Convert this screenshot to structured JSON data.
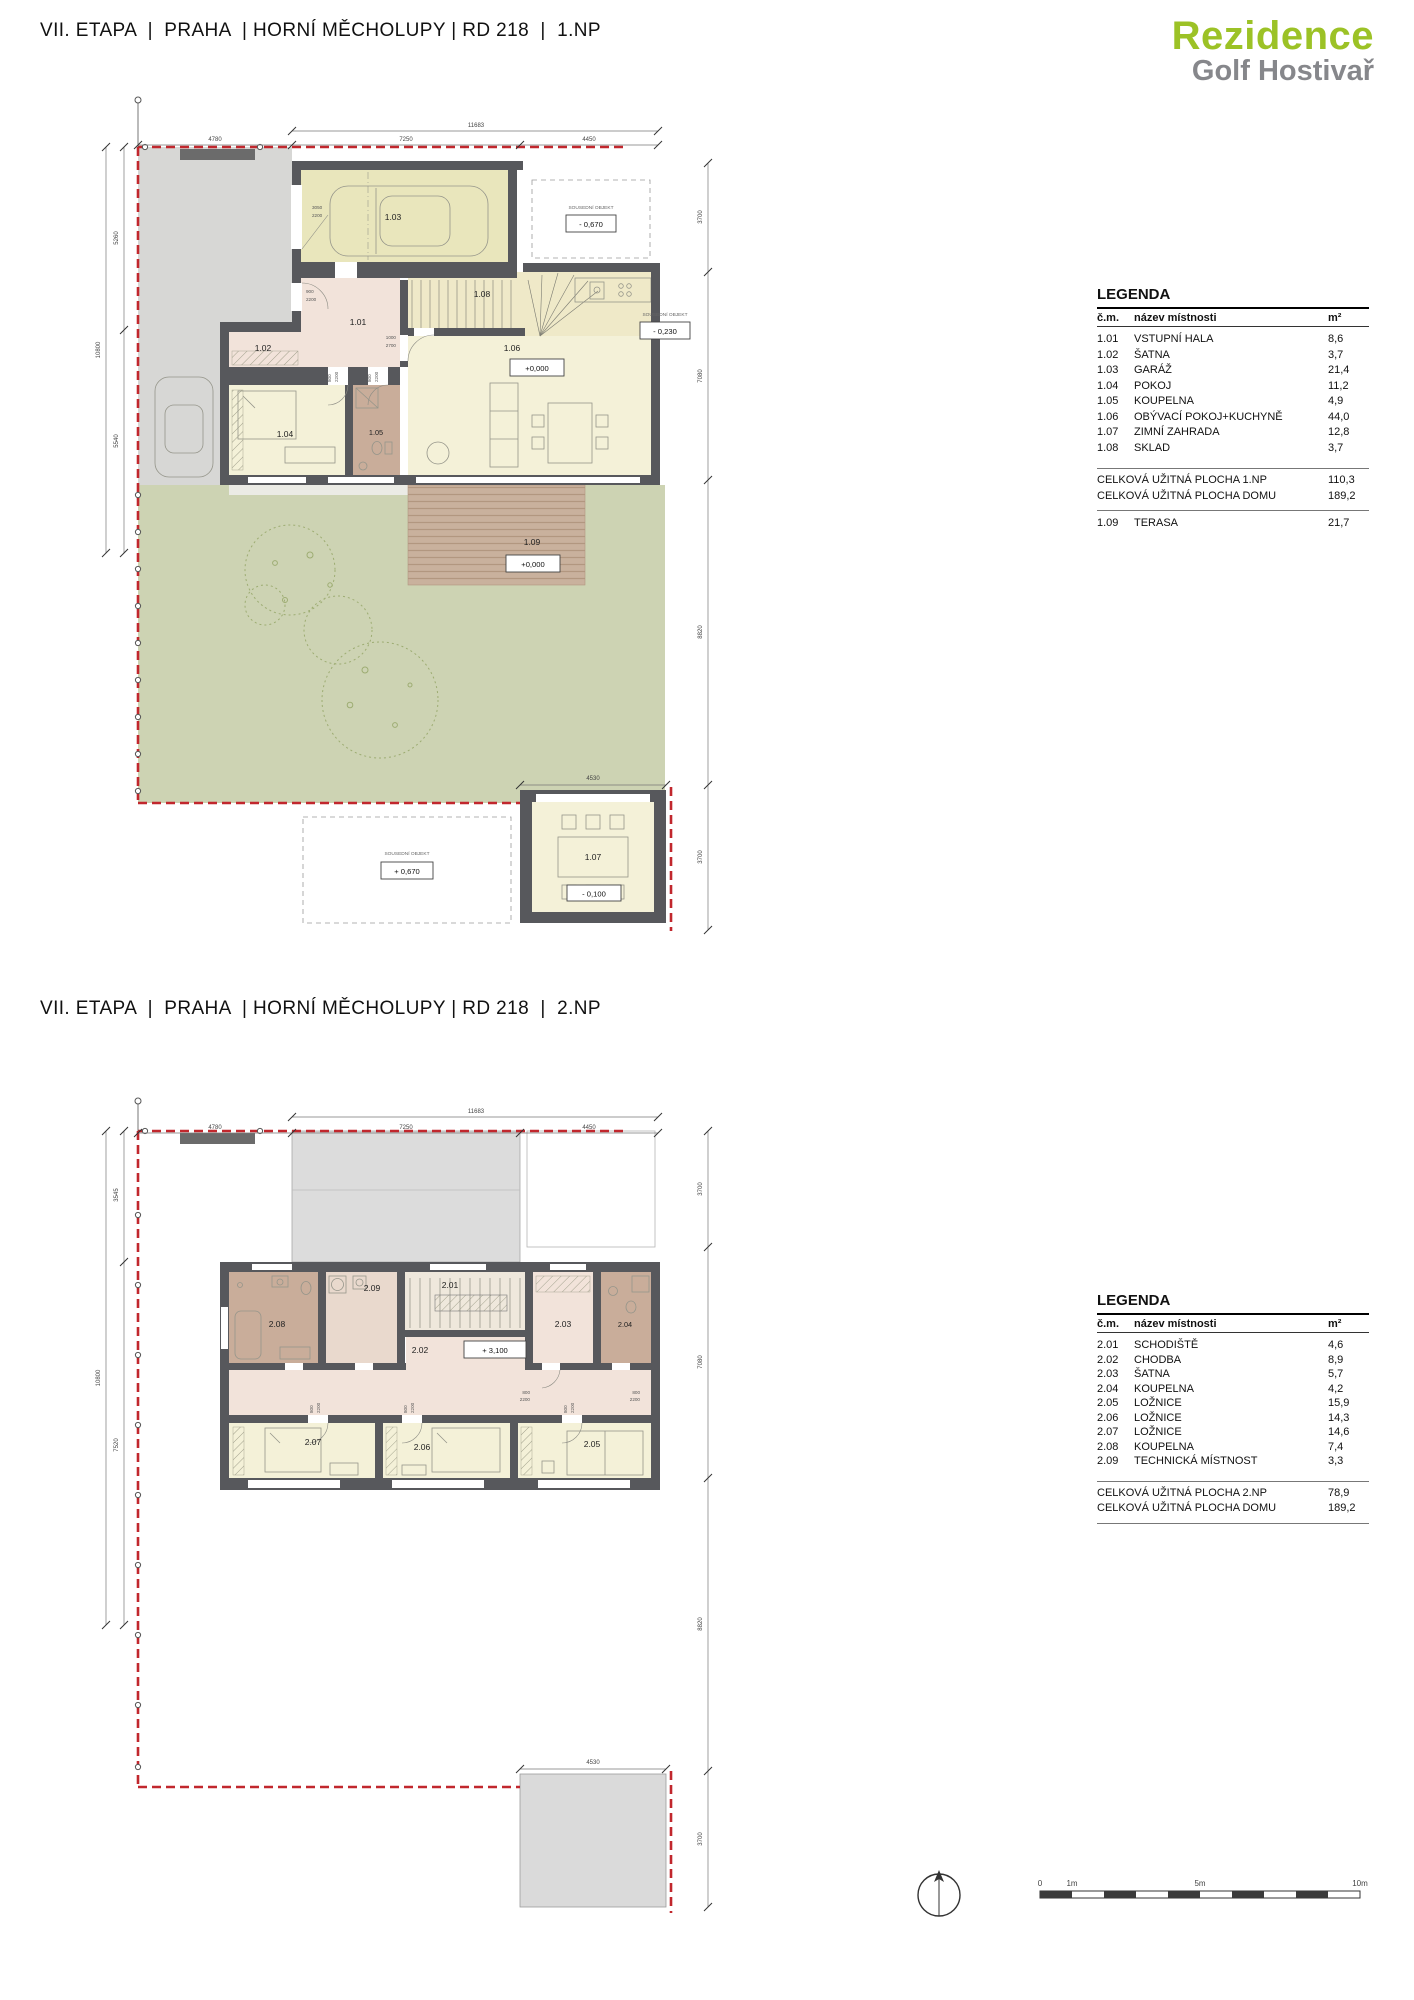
{
  "header": {
    "title_1np": "VII. ETAPA  |  PRAHA  | HORNÍ MĚCHOLUPY | RD 218  |  1.NP",
    "title_2np": "VII. ETAPA  |  PRAHA  | HORNÍ MĚCHOLUPY | RD 218  |  2.NP",
    "logo_line1": "Rezidence",
    "logo_line2": "Golf Hostivař"
  },
  "colors": {
    "logo_green": "#9cc226",
    "logo_gray": "#86878b",
    "boundary_red": "#c1272d",
    "wall_gray": "#57585c",
    "garage_fill": "#e9e6bc",
    "living_fill": "#f4f1d8",
    "hall_fill": "#f2e3da",
    "bath_fill": "#c9ad9a",
    "garden_fill": "#cdd3b3",
    "terrace_fill": "#c9b19d",
    "paving_gray": "#d7d7d5"
  },
  "plan_1np": {
    "rooms": {
      "r101": "1.01",
      "r102": "1.02",
      "r103": "1.03",
      "r104": "1.04",
      "r105": "1.05",
      "r106": "1.06",
      "r107": "1.07",
      "r108": "1.08",
      "r109": "1.09"
    },
    "dims": {
      "total_top": "11683",
      "top": [
        "4780",
        "7250",
        "4450"
      ],
      "left": [
        "5260",
        "5540"
      ],
      "left_total": "10800",
      "right": [
        "3700",
        "7080",
        "8820",
        "3700"
      ],
      "bottom": "4530"
    },
    "neighbor_label": "SOUSEDNÍ OBJEKT",
    "elev": {
      "neighbor_top": "- 0,670",
      "neighbor_right": "- 0,230",
      "neighbor_bottom": "+ 0,670",
      "living": "+0,000",
      "terrace": "+0,000",
      "winter": "- 0,100"
    },
    "doors": [
      [
        "3050",
        "2200"
      ],
      [
        "900",
        "2200"
      ],
      [
        "1000",
        "2700"
      ],
      [
        "800",
        "2200"
      ],
      [
        "800",
        "2200"
      ]
    ]
  },
  "plan_2np": {
    "rooms": {
      "r201": "2.01",
      "r202": "2.02",
      "r203": "2.03",
      "r204": "2.04",
      "r205": "2.05",
      "r206": "2.06",
      "r207": "2.07",
      "r208": "2.08",
      "r209": "2.09"
    },
    "dims": {
      "total_top": "11683",
      "top": [
        "4780",
        "7250",
        "4450"
      ],
      "left": [
        "3545",
        "7520"
      ],
      "left_total": "10800",
      "right": [
        "3700",
        "7080",
        "8820",
        "3700"
      ],
      "bottom": "4530"
    },
    "elev": {
      "corridor": "+ 3,100"
    },
    "doors": [
      [
        "800",
        "2200"
      ],
      [
        "800",
        "2200"
      ],
      [
        "800",
        "2200"
      ],
      [
        "800",
        "2200"
      ],
      [
        "800",
        "2200"
      ]
    ]
  },
  "legend_1np": {
    "title": "LEGENDA",
    "col_num": "č.m.",
    "col_name": "název místnosti",
    "col_area": "m²",
    "rows": [
      [
        "1.01",
        "VSTUPNÍ HALA",
        "8,6"
      ],
      [
        "1.02",
        "ŠATNA",
        "3,7"
      ],
      [
        "1.03",
        "GARÁŽ",
        "21,4"
      ],
      [
        "1.04",
        "POKOJ",
        "11,2"
      ],
      [
        "1.05",
        "KOUPELNA",
        "4,9"
      ],
      [
        "1.06",
        "OBÝVACÍ POKOJ+KUCHYNĚ",
        "44,0"
      ],
      [
        "1.07",
        "ZIMNÍ ZAHRADA",
        "12,8"
      ],
      [
        "1.08",
        "SKLAD",
        "3,7"
      ]
    ],
    "total1_label": "CELKOVÁ UŽITNÁ PLOCHA 1.NP",
    "total1_value": "110,3",
    "total2_label": "CELKOVÁ UŽITNÁ PLOCHA DOMU",
    "total2_value": "189,2",
    "extra_row": [
      "1.09",
      "TERASA",
      "21,7"
    ]
  },
  "legend_2np": {
    "title": "LEGENDA",
    "col_num": "č.m.",
    "col_name": "název místnosti",
    "col_area": "m²",
    "rows": [
      [
        "2.01",
        "SCHODIŠTĚ",
        "4,6"
      ],
      [
        "2.02",
        "CHODBA",
        "8,9"
      ],
      [
        "2.03",
        "ŠATNA",
        "5,7"
      ],
      [
        "2.04",
        "KOUPELNA",
        "4,2"
      ],
      [
        "2.05",
        "LOŽNICE",
        "15,9"
      ],
      [
        "2.06",
        "LOŽNICE",
        "14,3"
      ],
      [
        "2.07",
        "LOŽNICE",
        "14,6"
      ],
      [
        "2.08",
        "KOUPELNA",
        "7,4"
      ],
      [
        "2.09",
        "TECHNICKÁ MÍSTNOST",
        "3,3"
      ]
    ],
    "total1_label": "CELKOVÁ UŽITNÁ PLOCHA 2.NP",
    "total1_value": "78,9",
    "total2_label": "CELKOVÁ UŽITNÁ PLOCHA DOMU",
    "total2_value": "189,2"
  },
  "scalebar": {
    "labels": [
      "0",
      "1m",
      "5m",
      "10m"
    ]
  }
}
